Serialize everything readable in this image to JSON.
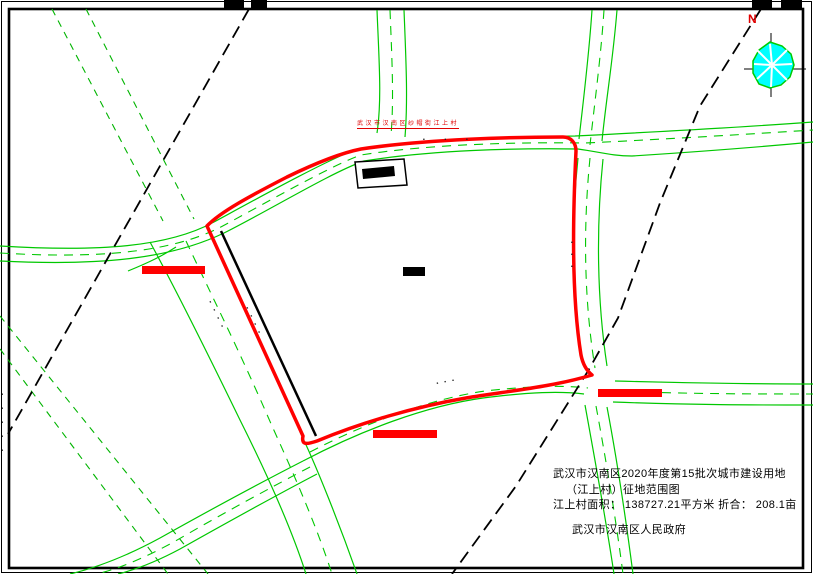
{
  "colors": {
    "road_green": "#00c800",
    "road_green_dark": "#00b400",
    "boundary_red": "#ff0000",
    "line_black": "#000000",
    "tree_cyan": "#00ffff",
    "label_red": "#e00000"
  },
  "north_indicator": {
    "label": "N"
  },
  "labels": {
    "village": "武汉市汉南区纱帽街江上村",
    "road_top": "▪ ▪ ▪",
    "road_right": "▪▪▪",
    "road_sw": "▪▪▪▪",
    "road_sw_inner": "▪▪▪▪",
    "road_bottom": "▪▪▪",
    "edge_left": "▪▪▪▪▪"
  },
  "title_block": {
    "line1": "武汉市汉南区2020年度第15批次城市建设用地",
    "line2": "（江上村）征地范围图",
    "line3": "江上村面积： 138727.21平方米 折合： 208.1亩",
    "line4": "武汉市汉南区人民政府"
  }
}
